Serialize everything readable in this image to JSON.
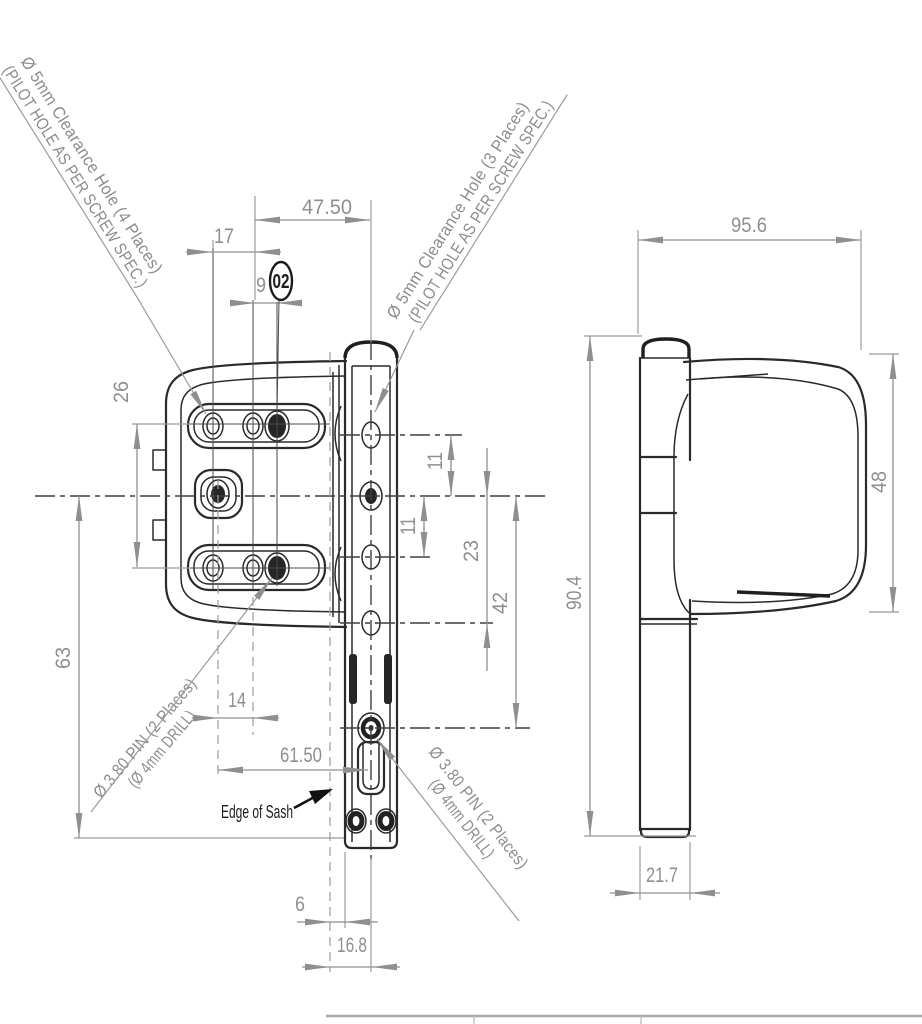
{
  "notes": {
    "clearance_left_1": "Ø 5mm Clearance Hole (4 Places)",
    "clearance_left_2": "(PILOT HOLE AS PER SCREW SPEC.)",
    "clearance_right_1": "Ø 5mm Clearance Hole (3 Places)",
    "clearance_right_2": "(PILOT HOLE AS PER SCREW SPEC.)",
    "pin_left_1": "Ø 3.80 PIN (2 Places)",
    "pin_left_2": "(Ø 4mm DRILL)",
    "pin_right_1": "Ø 3.80 PIN (2 Places)",
    "pin_right_2": "(Ø 4mm DRILL)",
    "edge_of_sash": "Edge of Sash",
    "balloon": "02"
  },
  "dims": {
    "w475": "47.50",
    "w17": "17",
    "w9": "9",
    "h26": "26",
    "h63": "63",
    "h11a": "11",
    "h11b": "11",
    "h23": "23",
    "h42": "42",
    "w14": "14",
    "w615": "61.50",
    "w6": "6",
    "w168": "16.8",
    "w956": "95.6",
    "h48": "48",
    "h904": "90.4",
    "w217": "21.7"
  },
  "colors": {
    "background": "#ffffff",
    "outline": "#2a2a2a",
    "dimension": "#8f8f8f",
    "dark_text": "#1c1c1c"
  }
}
